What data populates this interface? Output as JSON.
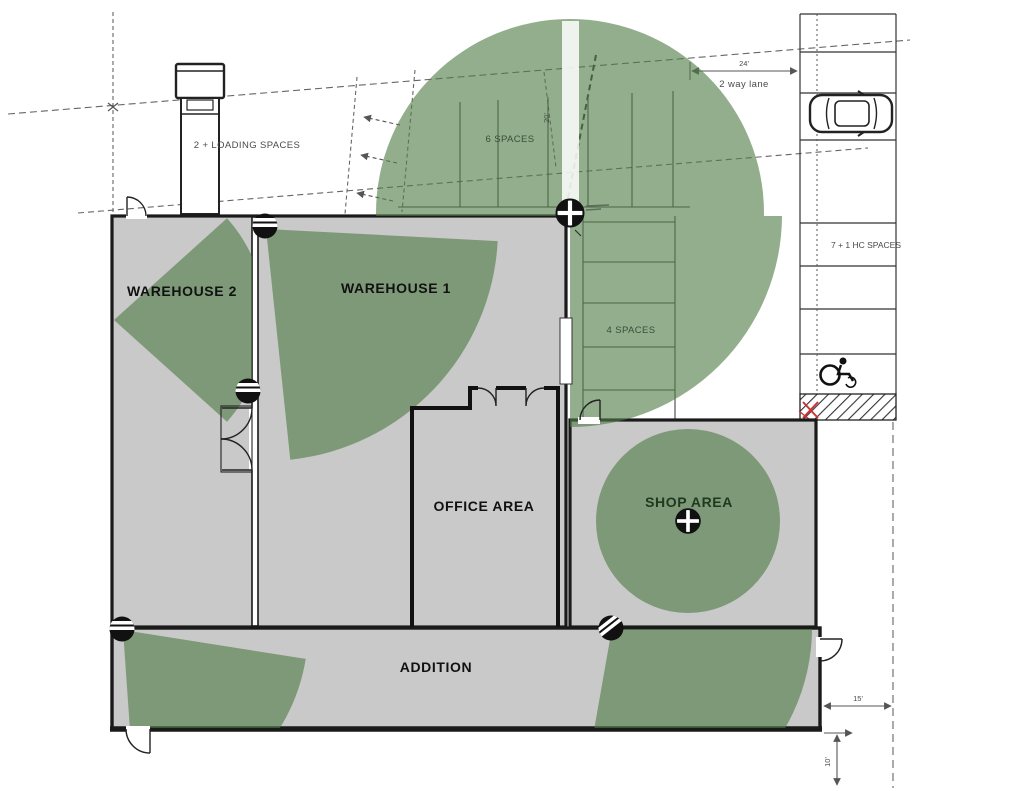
{
  "drawing": {
    "rooms": {
      "warehouse2": "WAREHOUSE 2",
      "warehouse1": "WAREHOUSE 1",
      "office": "OFFICE AREA",
      "shop": "SHOP AREA",
      "addition": "ADDITION"
    },
    "parking": {
      "loading_label": "2 + LOADING SPACES",
      "top_row_label": "6 SPACES",
      "mid_row_label": "4 SPACES",
      "east_row_label": "7 + 1 HC SPACES"
    },
    "lane": {
      "width_dim": "24'",
      "label": "2 way lane"
    },
    "dimensions": {
      "stall_depth": "20'",
      "east_setback": "15'",
      "south_setback": "10'"
    },
    "icons": {
      "ptz_camera": "ptz-camera-icon",
      "dome_camera": "dome-camera-icon",
      "car": "car-icon",
      "truck": "truck-icon",
      "wheelchair": "wheelchair-icon",
      "red_x": "red-x-mark"
    },
    "colors": {
      "coverage_green": "#8fab89",
      "floor_gray": "#c9c9c9",
      "wall_black": "#1a1a1a",
      "annotation_gray": "#4a4a4a",
      "alert_red": "#cc3333"
    }
  }
}
